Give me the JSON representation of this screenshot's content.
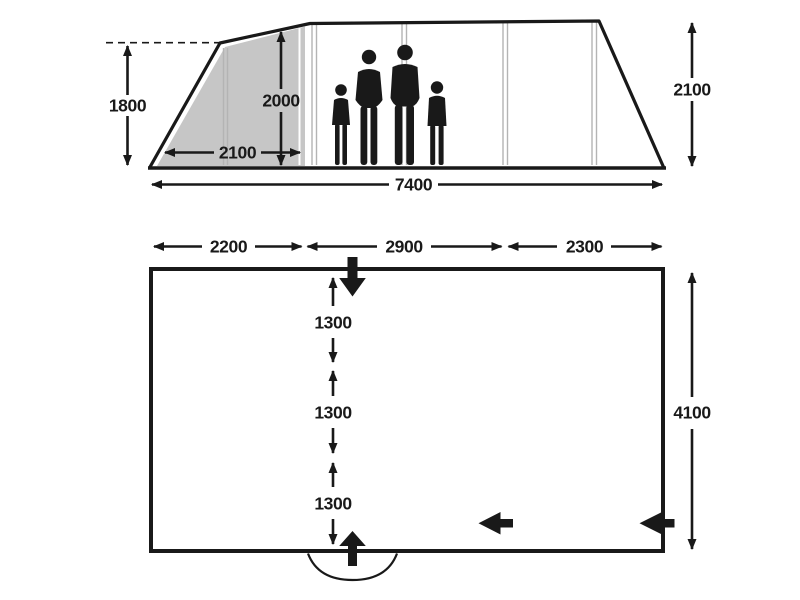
{
  "title": "Family tunnel tent dimensions diagram",
  "colors": {
    "line": "#191919",
    "shaded_area": "#c6c6c6",
    "seam_line": "#b4b4b4",
    "background": "#ffffff"
  },
  "side_view": {
    "peak_height_left": "1800",
    "inner_height": "2000",
    "porch_depth": "2100",
    "total_length": "7400",
    "height_right": "2100",
    "figures": "family-silhouette-of-four"
  },
  "floor_plan": {
    "section_widths": [
      "2200",
      "2900",
      "2300"
    ],
    "cabin_depths": [
      "1300",
      "1300",
      "1300"
    ],
    "total_depth": "4100",
    "sleeping_bag_count": 6,
    "icons": {
      "front_entrance": "arrow-down",
      "rear_entrance": "arrow-up",
      "inner_door": "arrow-left",
      "side_door": "arrow-left"
    }
  }
}
